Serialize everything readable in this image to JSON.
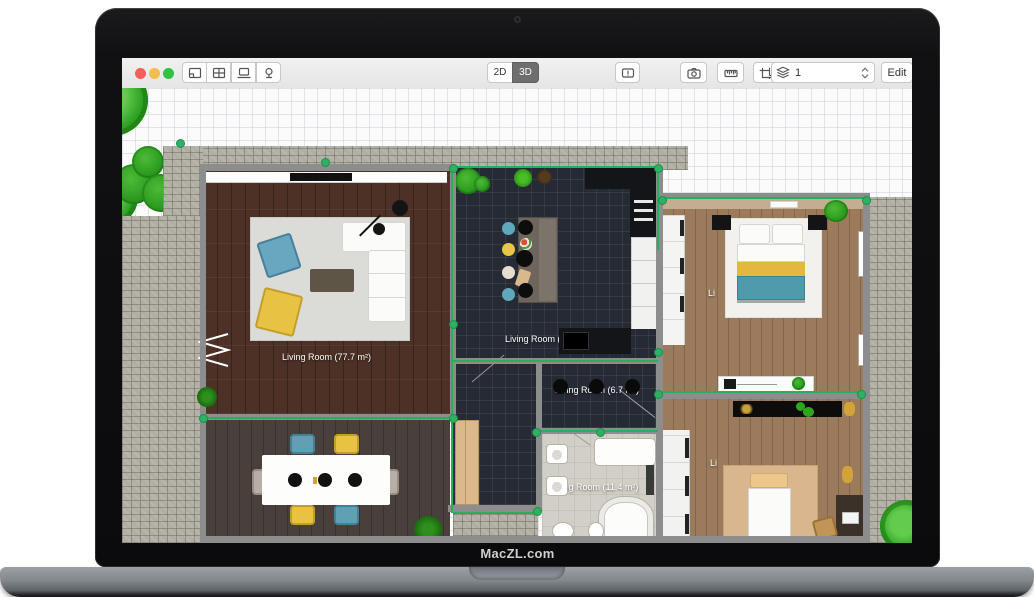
{
  "device": {
    "brand_label": "MacZL.com"
  },
  "toolbar": {
    "traffic_lights": {
      "close": "#f4605a",
      "minimize": "#f3bd4d",
      "zoom": "#32c146"
    },
    "left_buttons": [
      "floorplan-tool",
      "grid-tool",
      "display-tool",
      "tree-tool"
    ],
    "view_toggle": {
      "options": [
        "2D",
        "3D"
      ],
      "active": "3D"
    },
    "right_buttons": [
      "annotation",
      "camera",
      "ruler",
      "crop"
    ],
    "layers": {
      "value": "1"
    },
    "edit_label": "Edit"
  },
  "floorplan": {
    "selection_color": "#27b05c",
    "rooms": [
      {
        "id": "living-room",
        "label": "Living Room (77.7 m²)"
      },
      {
        "id": "kitchen",
        "label": "Living Room (3"
      },
      {
        "id": "hallway",
        "label": "Living Room (6.7 m²)"
      },
      {
        "id": "bathroom",
        "label": "Living Room (11.4 m²)"
      },
      {
        "id": "bedroom-top",
        "label": "Li"
      },
      {
        "id": "bedroom-bottom",
        "label": "Li"
      }
    ],
    "floor_colors": {
      "living": "#4d3126",
      "dining": "#4a403b",
      "kitchen": "#262a35",
      "bathroom": "#d2cfc7",
      "bedrooms": "#9c7b5c",
      "patio": "#b1afa4"
    }
  }
}
